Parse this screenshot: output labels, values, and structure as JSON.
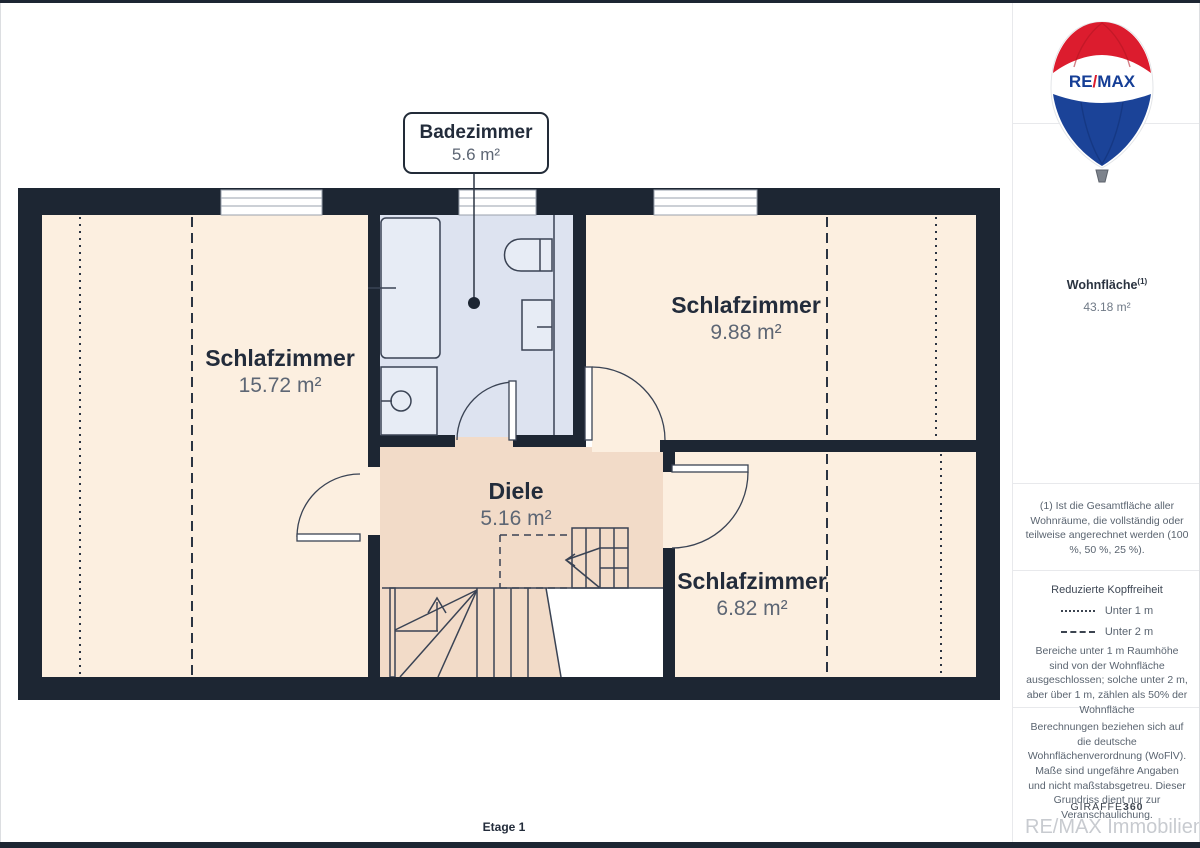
{
  "floor": {
    "label": "Etage 1"
  },
  "callout": {
    "room": "Badezimmer",
    "area": "5.6 m²"
  },
  "rooms": [
    {
      "name": "Schlafzimmer",
      "area": "15.72 m²"
    },
    {
      "name": "Schlafzimmer",
      "area": "9.88 m²"
    },
    {
      "name": "Diele",
      "area": "5.16 m²"
    },
    {
      "name": "Schlafzimmer",
      "area": "6.82 m²"
    }
  ],
  "sidebar": {
    "total": {
      "label": "Wohnfläche",
      "sup": "(1)",
      "value": "43.18 m²"
    },
    "footnote": "(1) Ist die Gesamtfläche aller Wohnräume, die vollständig oder teilweise angerechnet werden (100 %, 50 %, 25 %).",
    "legend": {
      "title": "Reduzierte Kopffreiheit",
      "items": [
        {
          "style": "dotted",
          "label": "Unter 1 m"
        },
        {
          "style": "dashed",
          "label": "Unter 2 m"
        }
      ],
      "note": "Bereiche unter 1 m Raumhöhe sind von der Wohnfläche ausgeschlossen; solche unter 2 m, aber über 1 m, zählen als 50% der Wohnfläche"
    },
    "disclaimer": "Berechnungen beziehen sich auf die deutsche Wohnflächenverordnung (WoFlV). Maße sind ungefähre Angaben und nicht maßstabsgetreu. Dieser Grundriss dient nur zur Veranschaulichung."
  },
  "branding": {
    "balloon": {
      "re": "RE",
      "slash": "/",
      "max": "MAX"
    },
    "giraffe_prefix": "GIRAFFE",
    "giraffe_suffix": "360",
    "agency": "RE/MAX Immobilien DeLux"
  },
  "colors": {
    "wall": "#1d2633",
    "room_fill": "#fcefe0",
    "hall_fill": "#f2dbc8",
    "bath_fill": "#dde3f0",
    "remax_red": "#dc1c2e",
    "remax_blue": "#1b4398",
    "text_dark": "#232c3b",
    "text_gray": "#5d6674"
  }
}
